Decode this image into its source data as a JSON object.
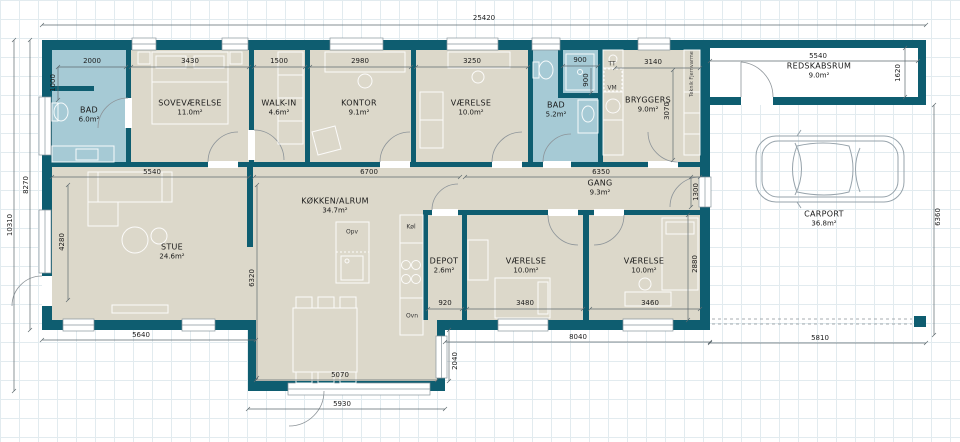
{
  "rooms": {
    "bad1": {
      "name": "BAD",
      "area": "6.0m²"
    },
    "sovevaerelse": {
      "name": "SOVEVÆRELSE",
      "area": "11.0m²"
    },
    "walkin": {
      "name": "WALK-IN",
      "area": "4.6m²"
    },
    "kontor": {
      "name": "KONTOR",
      "area": "9.1m²"
    },
    "vaerelse_top": {
      "name": "VÆRELSE",
      "area": "10.0m²"
    },
    "bad2": {
      "name": "BAD",
      "area": "5.2m²"
    },
    "bryggers": {
      "name": "BRYGGERS",
      "area": "9.0m²"
    },
    "redskabsrum": {
      "name": "REDSKABSRUM",
      "area": "9.0m²"
    },
    "stue": {
      "name": "STUE",
      "area": "24.6m²"
    },
    "kokken_alrum": {
      "name": "KØKKEN/ALRUM",
      "area": "34.7m²"
    },
    "gang": {
      "name": "GANG",
      "area": "9.3m²"
    },
    "depot": {
      "name": "DEPOT",
      "area": "2.6m²"
    },
    "vaerelse_bl": {
      "name": "VÆRELSE",
      "area": "10.0m²"
    },
    "vaerelse_br": {
      "name": "VÆRELSE",
      "area": "10.0m²"
    },
    "carport": {
      "name": "CARPORT",
      "area": "36.8m²"
    }
  },
  "appliances": {
    "tt": "TT",
    "vm": "VM",
    "opv": "Opv",
    "koel": "Køl",
    "ovn": "Ovn",
    "teknik": "Teknik Fjernvarme"
  },
  "dimensions_mm": {
    "total_width": "25420",
    "bad1_width": "2000",
    "bad1_depth": "1000",
    "sovevaerelse_width": "3430",
    "walkin_width": "1500",
    "kontor_width": "2980",
    "vaerelse_top_width": "3250",
    "bad2_niche_width": "900",
    "bad2_niche_depth": "900",
    "bryggers_width": "3140",
    "bryggers_depth": "3070",
    "redskabsrum_width": "5540",
    "redskabsrum_depth": "1620",
    "stue_top_width": "5540",
    "kokken_top_width": "6700",
    "gang_width": "6350",
    "gang_door": "1300",
    "left_total": "10310",
    "left_inner": "8270",
    "stue_depth": "4280",
    "kokken_depth": "6320",
    "depot_width": "920",
    "vaerelse_bl_width": "3480",
    "vaerelse_br_width": "3460",
    "vaerelse_depth": "2880",
    "extension_depth": "2040",
    "stue_bottom_width": "5640",
    "dining_width": "5070",
    "extension_bottom_width": "5930",
    "bottom_right_width": "8040",
    "carport_width": "5810",
    "carport_depth": "6360"
  },
  "colors": {
    "wall": "#0e5d70",
    "bathroom": "#a6cad5",
    "floor": "#dcd8ca"
  }
}
